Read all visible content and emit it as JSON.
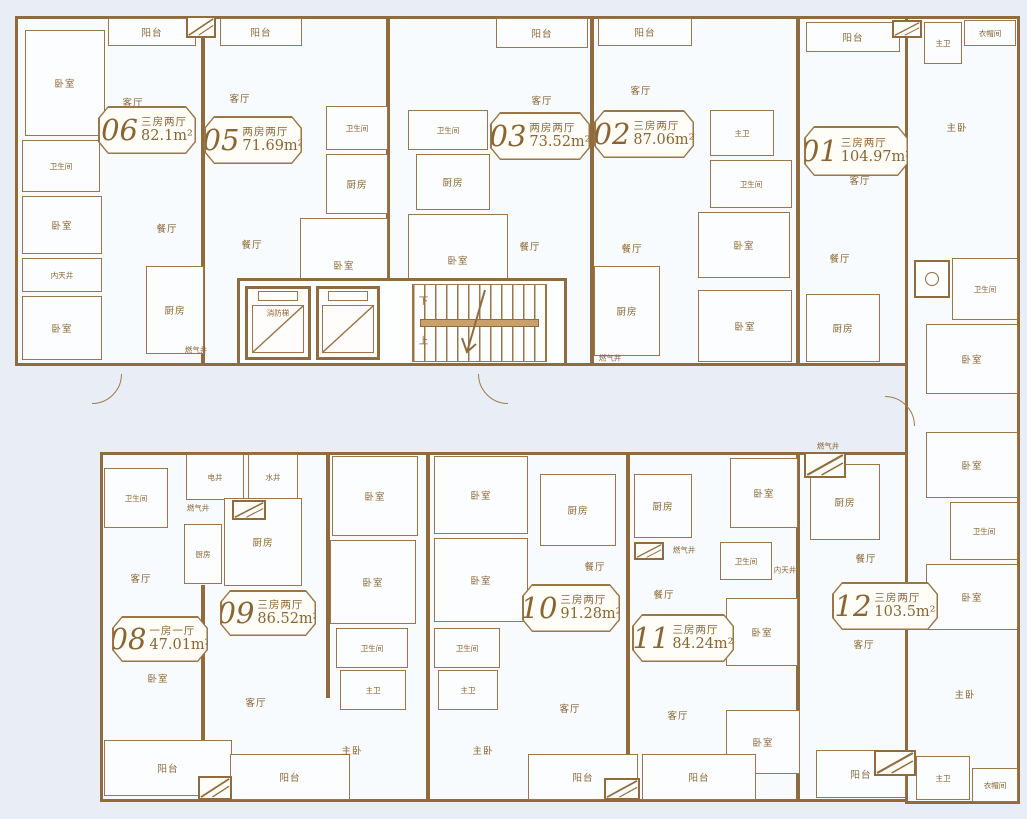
{
  "colors": {
    "wall": "#8f6b3e",
    "line": "#9a7648",
    "text": "#8a6531",
    "room_fill": "#fbfdff",
    "page_bg": "#e9eef6",
    "badge_bg": "#fffdf8"
  },
  "labels": {
    "bedroom": "卧室",
    "master_bedroom": "主卧",
    "living_room": "客厅",
    "dining_room": "餐厅",
    "kitchen": "厨房",
    "bathroom": "卫生间",
    "master_bathroom": "主卫",
    "balcony": "阳台",
    "cloakroom": "衣帽间",
    "inner_courtyard": "内天井",
    "electric_shaft": "电井",
    "water_shaft": "水井",
    "gas_shaft": "燃气井",
    "fire_elevator": "消防梯",
    "stairs_up": "上",
    "stairs_down": "下"
  },
  "units": [
    {
      "id": "06",
      "type": "三房两厅",
      "area": "82.1m²"
    },
    {
      "id": "05",
      "type": "两房两厅",
      "area": "71.69m²"
    },
    {
      "id": "03",
      "type": "两房两厅",
      "area": "73.52m²"
    },
    {
      "id": "02",
      "type": "三房两厅",
      "area": "87.06m²"
    },
    {
      "id": "01",
      "type": "三房两厅",
      "area": "104.97m²"
    },
    {
      "id": "08",
      "type": "一房一厅",
      "area": "47.01m²"
    },
    {
      "id": "09",
      "type": "三房两厅",
      "area": "86.52m²"
    },
    {
      "id": "10",
      "type": "三房两厅",
      "area": "91.28m²"
    },
    {
      "id": "11",
      "type": "三房两厅",
      "area": "84.24m²"
    },
    {
      "id": "12",
      "type": "三房两厅",
      "area": "103.5m²"
    }
  ]
}
